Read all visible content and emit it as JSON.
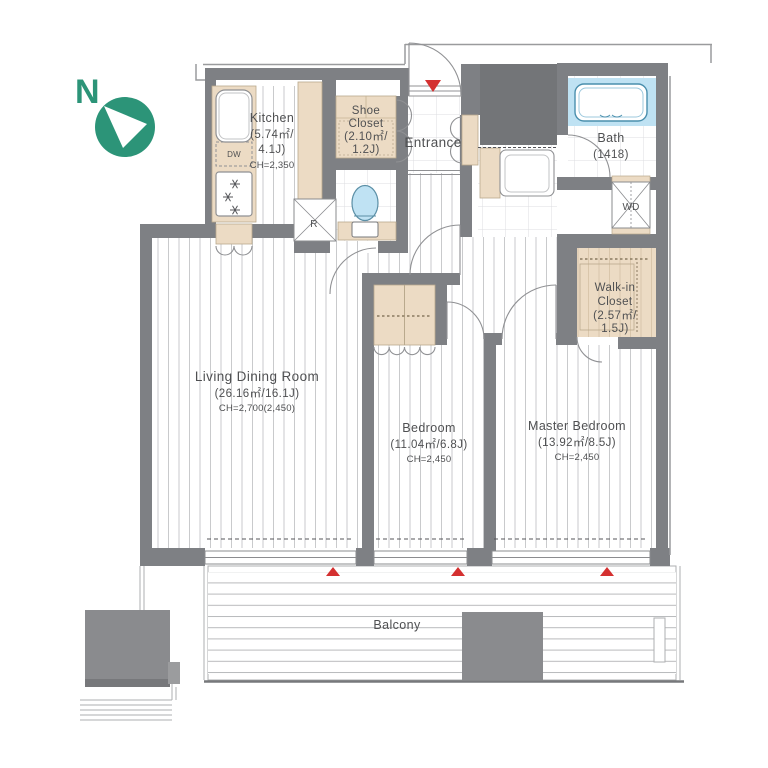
{
  "north": {
    "label": "N"
  },
  "rooms": {
    "kitchen": {
      "name": "Kitchen",
      "area": "(5.74㎡/",
      "size": "4.1J)",
      "ceiling": "CH=2,350"
    },
    "shoe_closet": {
      "name1": "Shoe",
      "name2": "Closet",
      "area": "(2.10㎡/",
      "size": "1.2J)"
    },
    "entrance": {
      "name": "Entrance"
    },
    "bath": {
      "name": "Bath",
      "size": "(1418)"
    },
    "walk_in_closet": {
      "name1": "Walk-in",
      "name2": "Closet",
      "area": "(2.57㎡/",
      "size": "1.5J)"
    },
    "living_dining": {
      "name": "Living Dining Room",
      "area": "(26.16㎡/16.1J)",
      "ceiling": "CH=2,700(2,450)"
    },
    "bedroom": {
      "name": "Bedroom",
      "area": "(11.04㎡/6.8J)",
      "ceiling": "CH=2,450"
    },
    "master_bedroom": {
      "name": "Master Bedroom",
      "area": "(13.92㎡/8.5J)",
      "ceiling": "CH=2,450"
    },
    "balcony": {
      "name": "Balcony"
    }
  },
  "fixtures": {
    "dishwasher": "DW",
    "refrigerator": "R",
    "washer_dryer": "WD"
  },
  "colors": {
    "wall": "#7e8084",
    "pipe_shaft": "#737578",
    "cabinet_beige": "#ecdbc4",
    "water_blue": "#bfe2f3",
    "entrance_red": "#d43030",
    "north_green": "#2c9478"
  }
}
